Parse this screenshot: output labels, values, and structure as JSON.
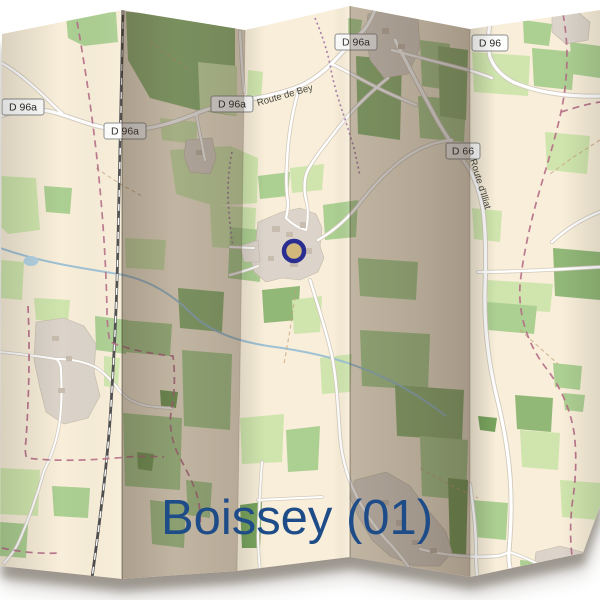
{
  "window": {
    "width": 600,
    "height": 600
  },
  "map": {
    "title": "Boissey (01)",
    "title_color": "#1e4c88",
    "road_badges": [
      {
        "label": "D 96a"
      },
      {
        "label": "D 96a"
      },
      {
        "label": "D 96a"
      },
      {
        "label": "D 96a"
      },
      {
        "label": "D 96"
      },
      {
        "label": "D 66"
      }
    ],
    "street_labels": [
      {
        "text": "Route de Bey"
      },
      {
        "text": "Route d'Illiat"
      }
    ],
    "marker": {
      "type": "circle-outline",
      "color": "#2b2e91"
    },
    "colors": {
      "land": "#f8eed9",
      "meadow": "#cfe5ad",
      "forest": "#92b878",
      "village": "#dcd4ca",
      "road": "#ffffff",
      "boundary": "#b56b86",
      "railway": "#4a4a4a",
      "water": "#a9cde0",
      "fold_shadow": "#42322466"
    }
  }
}
